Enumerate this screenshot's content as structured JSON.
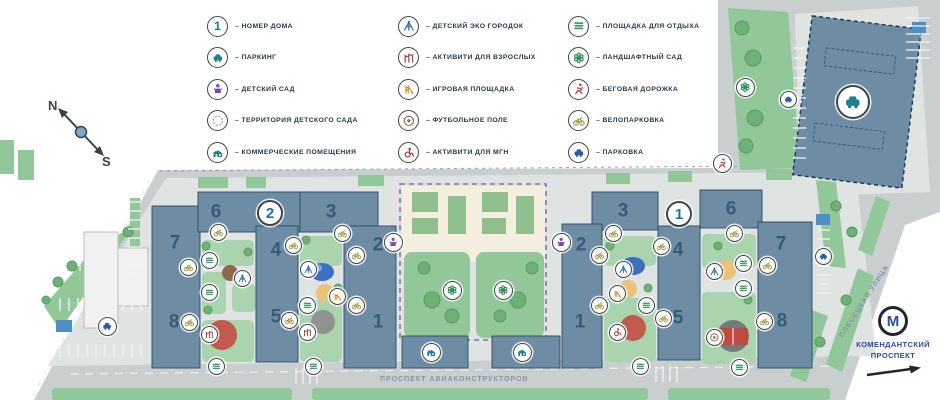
{
  "colors": {
    "road_gray": "#c9cecf",
    "paving_light": "#dfe3e2",
    "courtyard": "#e9ebea",
    "green": "#92c79a",
    "tree_green": "#6fb078",
    "building_blue": "#6e8ca3",
    "building_outline": "#2a4a66",
    "kindergarten_cream": "#f4eede",
    "territory_purple": "#8b6fae",
    "badge_ring": "#3b4649",
    "accent_teal": "#1f808f",
    "accent_purple": "#7b4ba0",
    "accent_blue": "#2f6db5",
    "accent_darkred": "#a04545",
    "accent_orange": "#d9892f",
    "accent_brown": "#8a6f52",
    "accent_red": "#b03a30",
    "accent_green": "#3f9e63",
    "accent_olive": "#9a9a3d",
    "accent_parkblue": "#2a5aa8",
    "metro_blue": "#2b4aa5",
    "number_blue": "#1f6f9f"
  },
  "compass": {
    "north": "N",
    "south": "S"
  },
  "legend": {
    "dash": "–",
    "columns": [
      {
        "items": [
          {
            "icon": "num",
            "text": "1",
            "label": "НОМЕР ДОМА"
          },
          {
            "icon": "parkingcar",
            "label": "ПАРКИНГ"
          },
          {
            "icon": "kind",
            "label": "ДЕТСКИЙ САД"
          },
          {
            "icon": "territory",
            "label": "ТЕРРИТОРИЯ ДЕТСКОГО САДА"
          },
          {
            "icon": "commercial",
            "label": "КОММЕРЧЕСКИЕ ПОМЕЩЕНИЯ"
          }
        ]
      },
      {
        "items": [
          {
            "icon": "eco",
            "label": "ДЕТСКИЙ ЭКО ГОРОДОК"
          },
          {
            "icon": "adults",
            "label": "АКТИВИТИ ДЛЯ ВЗРОСЛЫХ"
          },
          {
            "icon": "play",
            "label": "ИГРОВАЯ ПЛОЩАДКА"
          },
          {
            "icon": "foot",
            "label": "ФУТБОЛЬНОЕ ПОЛЕ"
          },
          {
            "icon": "mgn",
            "label": "АКТИВИТИ ДЛЯ МГН"
          }
        ]
      },
      {
        "items": [
          {
            "icon": "bench",
            "label": "ПЛОЩАДКА ДЛЯ ОТДЫХА"
          },
          {
            "icon": "land",
            "label": "ЛАНДШАФТНЫЙ САД"
          },
          {
            "icon": "run",
            "label": "БЕГОВАЯ ДОРОЖКА"
          },
          {
            "icon": "bike",
            "label": "ВЕЛОПАРКОВКА"
          },
          {
            "icon": "parkblue",
            "label": "ПАРКОВКА"
          }
        ]
      }
    ]
  },
  "map": {
    "streets": {
      "bottom": "ПРОСПЕКТ АВИАКОНСТРУКТОРОВ",
      "right": "ПЛЕСЕЦКАЯ УЛИЦА"
    },
    "metro": {
      "line1": "КОМЕНДАНТСКИЙ",
      "line2": "ПРОСПЕКТ"
    },
    "building_numbers": [
      {
        "n": "6",
        "x": 216,
        "y": 212
      },
      {
        "n": "7",
        "x": 175,
        "y": 243
      },
      {
        "n": "8",
        "x": 174,
        "y": 322
      },
      {
        "n": "4",
        "x": 276,
        "y": 250
      },
      {
        "n": "5",
        "x": 276,
        "y": 317
      },
      {
        "n": "3",
        "x": 331,
        "y": 212
      },
      {
        "n": "2",
        "x": 378,
        "y": 245
      },
      {
        "n": "1",
        "x": 378,
        "y": 322
      },
      {
        "n": "3",
        "x": 623,
        "y": 211
      },
      {
        "n": "2",
        "x": 581,
        "y": 245
      },
      {
        "n": "1",
        "x": 580,
        "y": 322
      },
      {
        "n": "4",
        "x": 678,
        "y": 250
      },
      {
        "n": "5",
        "x": 678,
        "y": 318
      },
      {
        "n": "6",
        "x": 731,
        "y": 209
      },
      {
        "n": "7",
        "x": 781,
        "y": 244
      },
      {
        "n": "8",
        "x": 782,
        "y": 321
      }
    ],
    "badges": [
      {
        "type": "num",
        "text": "2",
        "x": 270,
        "y": 213,
        "size": 26
      },
      {
        "type": "num",
        "text": "1",
        "x": 679,
        "y": 214,
        "size": 26
      },
      {
        "type": "parkingcar",
        "x": 853,
        "y": 102,
        "size": 34
      },
      {
        "type": "bike",
        "x": 218,
        "y": 232
      },
      {
        "type": "bench",
        "x": 209,
        "y": 260
      },
      {
        "type": "bike",
        "x": 188,
        "y": 267
      },
      {
        "type": "bench",
        "x": 209,
        "y": 292
      },
      {
        "type": "eco",
        "x": 242,
        "y": 278
      },
      {
        "type": "bike",
        "x": 189,
        "y": 322
      },
      {
        "type": "adults",
        "x": 209,
        "y": 334
      },
      {
        "type": "bench",
        "x": 216,
        "y": 366
      },
      {
        "type": "bike",
        "x": 293,
        "y": 245
      },
      {
        "type": "bike",
        "x": 342,
        "y": 233
      },
      {
        "type": "bike",
        "x": 356,
        "y": 255
      },
      {
        "type": "eco",
        "x": 308,
        "y": 269
      },
      {
        "type": "play",
        "x": 337,
        "y": 296
      },
      {
        "type": "bench",
        "x": 307,
        "y": 305
      },
      {
        "type": "bike",
        "x": 356,
        "y": 305
      },
      {
        "type": "bike",
        "x": 289,
        "y": 320
      },
      {
        "type": "adults",
        "x": 307,
        "y": 332
      },
      {
        "type": "bench",
        "x": 313,
        "y": 366
      },
      {
        "type": "kind",
        "x": 393,
        "y": 242,
        "size": 19
      },
      {
        "type": "kind",
        "x": 561,
        "y": 242,
        "size": 19
      },
      {
        "type": "land",
        "x": 452,
        "y": 290,
        "size": 19
      },
      {
        "type": "land",
        "x": 503,
        "y": 290,
        "size": 19
      },
      {
        "type": "commercial",
        "x": 431,
        "y": 352,
        "size": 19
      },
      {
        "type": "commercial",
        "x": 522,
        "y": 352,
        "size": 19
      },
      {
        "type": "bike",
        "x": 613,
        "y": 233
      },
      {
        "type": "bike",
        "x": 599,
        "y": 255
      },
      {
        "type": "bike",
        "x": 661,
        "y": 246
      },
      {
        "type": "eco",
        "x": 623,
        "y": 269
      },
      {
        "type": "play",
        "x": 617,
        "y": 293
      },
      {
        "type": "bench",
        "x": 646,
        "y": 305
      },
      {
        "type": "bike",
        "x": 599,
        "y": 305
      },
      {
        "type": "bike",
        "x": 663,
        "y": 318
      },
      {
        "type": "mgn",
        "x": 617,
        "y": 332
      },
      {
        "type": "bench",
        "x": 640,
        "y": 366
      },
      {
        "type": "bike",
        "x": 734,
        "y": 233
      },
      {
        "type": "eco",
        "x": 714,
        "y": 271
      },
      {
        "type": "bench",
        "x": 743,
        "y": 263
      },
      {
        "type": "bench",
        "x": 743,
        "y": 288
      },
      {
        "type": "bike",
        "x": 767,
        "y": 265
      },
      {
        "type": "foot",
        "x": 714,
        "y": 337
      },
      {
        "type": "bike",
        "x": 764,
        "y": 321
      },
      {
        "type": "bench",
        "x": 739,
        "y": 367
      },
      {
        "type": "land",
        "x": 745,
        "y": 87,
        "size": 19
      },
      {
        "type": "parkblue",
        "x": 788,
        "y": 99
      },
      {
        "type": "run",
        "x": 722,
        "y": 163,
        "size": 19
      },
      {
        "type": "parkblue",
        "x": 823,
        "y": 256
      },
      {
        "type": "parkblue",
        "x": 107,
        "y": 326,
        "size": 19
      }
    ]
  }
}
